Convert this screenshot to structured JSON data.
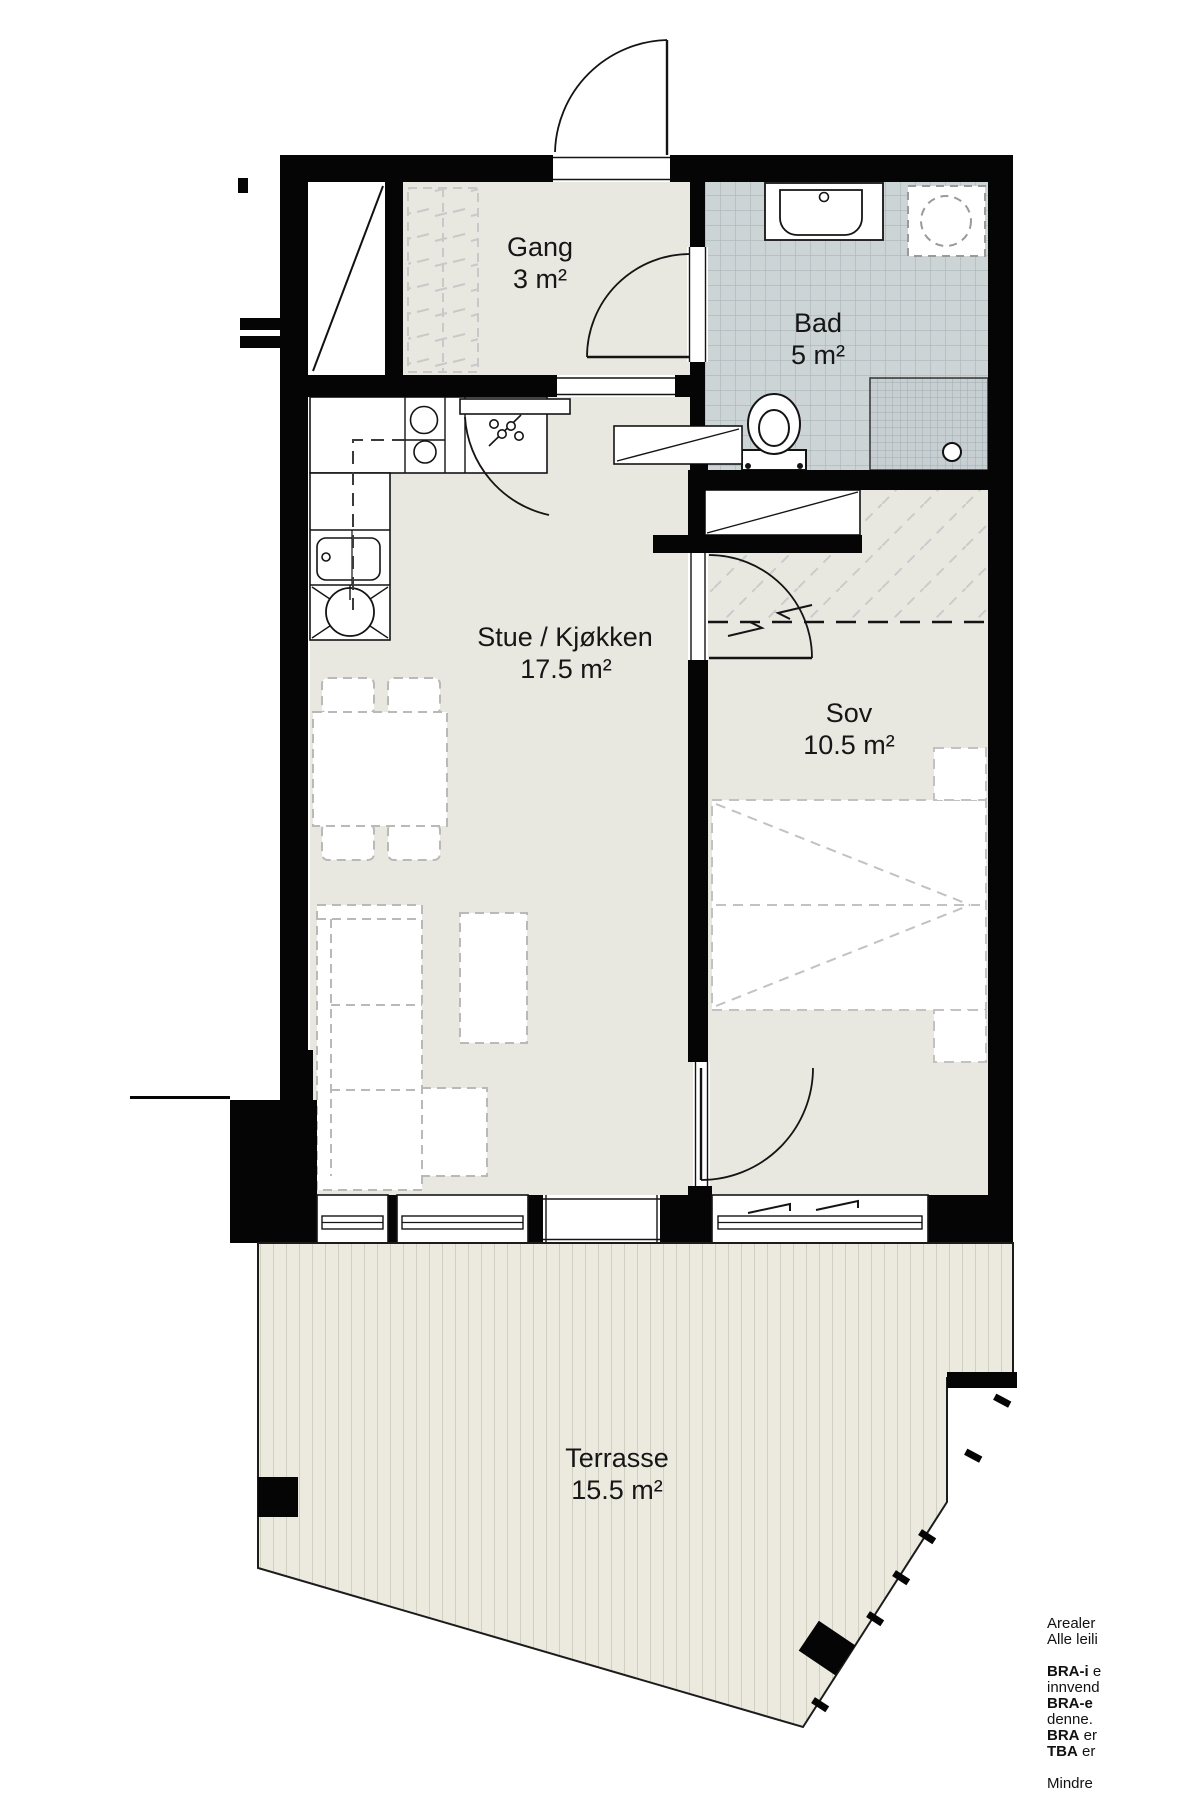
{
  "rooms": {
    "gang": {
      "name": "Gang",
      "area": "3 m²"
    },
    "bad": {
      "name": "Bad",
      "area": "5 m²"
    },
    "stue": {
      "name": "Stue / Kjøkken",
      "area": "17.5 m²"
    },
    "sov": {
      "name": "Sov",
      "area": "10.5 m²"
    },
    "terrasse": {
      "name": "Terrasse",
      "area": "15.5 m²"
    }
  },
  "legend": {
    "lines": [
      {
        "b": "",
        "t": "Arealer"
      },
      {
        "b": "",
        "t": "Alle leili"
      },
      {
        "b": "",
        "t": ""
      },
      {
        "b": "BRA-i",
        "t": " e"
      },
      {
        "b": "",
        "t": "innvend"
      },
      {
        "b": "BRA-e",
        "t": ""
      },
      {
        "b": "",
        "t": "denne."
      },
      {
        "b": "BRA",
        "t": " er"
      },
      {
        "b": "TBA",
        "t": " er"
      },
      {
        "b": "",
        "t": ""
      },
      {
        "b": "",
        "t": "Mindre"
      }
    ]
  },
  "colors": {
    "wall": "#050505",
    "floor": "#e8e7e0",
    "bath_tile": "#ccd4d6",
    "bath_tile_line": "#aab6ba",
    "terrace": "#eceadf",
    "terrace_stripe": "#c6c4b4",
    "furniture_dash": "#b9b9b9"
  }
}
